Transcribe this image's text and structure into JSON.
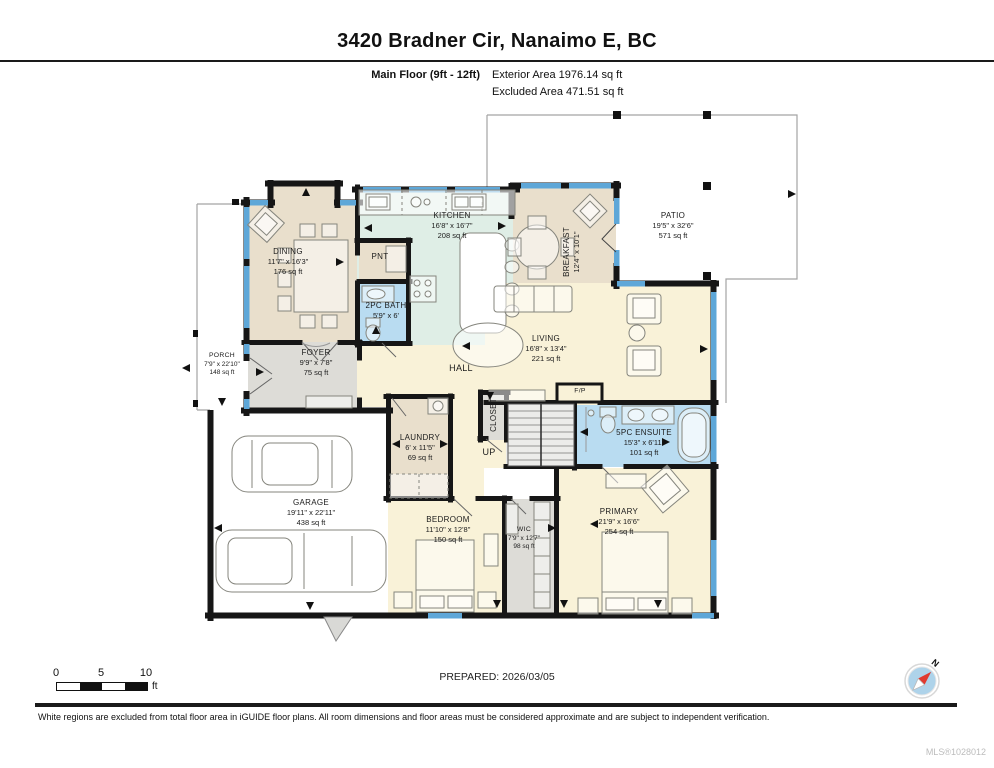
{
  "header": {
    "title": "3420 Bradner Cir, Nanaimo E, BC",
    "floor_label": "Main Floor (9ft - 12ft)",
    "exterior_area": "Exterior Area 1976.14 sq ft",
    "excluded_area": "Excluded Area 471.51 sq ft"
  },
  "rooms": {
    "dining": {
      "name": "DINING",
      "dims": "11'7\" x 16'3\"",
      "area": "176 sq ft"
    },
    "kitchen": {
      "name": "KITCHEN",
      "dims": "16'8\" x 16'7\"",
      "area": "208 sq ft"
    },
    "pantry": {
      "name": "PNT"
    },
    "bath": {
      "name": "2PC BATH",
      "dims": "5'9\" x 6'"
    },
    "breakfast": {
      "name": "BREAKFAST",
      "dims": "12'4\" x 10'1\""
    },
    "patio": {
      "name": "PATIO",
      "dims": "19'5\" x 32'6\"",
      "area": "571 sq ft"
    },
    "living": {
      "name": "LIVING",
      "dims": "16'8\" x 13'4\"",
      "area": "221 sq ft"
    },
    "hall": {
      "name": "HALL"
    },
    "foyer": {
      "name": "FOYER",
      "dims": "9'9\" x 7'8\"",
      "area": "75 sq ft"
    },
    "porch": {
      "name": "PORCH",
      "dims": "7'9\" x 22'10\"",
      "area": "148 sq ft"
    },
    "garage": {
      "name": "GARAGE",
      "dims": "19'11\" x 22'11\"",
      "area": "438 sq ft"
    },
    "laundry": {
      "name": "LAUNDRY",
      "dims": "6' x 11'5\"",
      "area": "69 sq ft"
    },
    "closet": {
      "name": "CLOSET"
    },
    "stairs": {
      "name": "UP"
    },
    "ensuite": {
      "name": "5PC ENSUITE",
      "dims": "15'3\" x 6'11\"",
      "area": "101 sq ft"
    },
    "bedroom": {
      "name": "BEDROOM",
      "dims": "11'10\" x 12'8\"",
      "area": "150 sq ft"
    },
    "wic": {
      "name": "WIC",
      "dims": "7'9\" x 12'7\"",
      "area": "98 sq ft"
    },
    "primary": {
      "name": "PRIMARY",
      "dims": "21'9\" x 16'6\"",
      "area": "254 sq ft"
    },
    "fireplace": {
      "name": "F/P"
    }
  },
  "scale_bar": {
    "tick0": "0",
    "tick5": "5",
    "tick10": "10",
    "unit": "ft"
  },
  "compass": {
    "north_label": "N"
  },
  "footer": {
    "prepared": "PREPARED: 2026/03/05",
    "disclaimer": "White regions are excluded from total floor area in iGUIDE floor plans. All room dimensions and floor areas must be considered approximate and are subject to independent verification.",
    "mls": "MLS®1028012"
  },
  "colors": {
    "wall": "#161616",
    "window": "#5ea7d8",
    "room_cream": "#f9f2d8",
    "room_beige": "#e9dfcc",
    "room_green": "#dfeee6",
    "room_blue": "#b9dcf1",
    "room_gray": "#dddcd7",
    "compass_blue": "#aed3ea",
    "needle_red": "#e03a2f"
  }
}
